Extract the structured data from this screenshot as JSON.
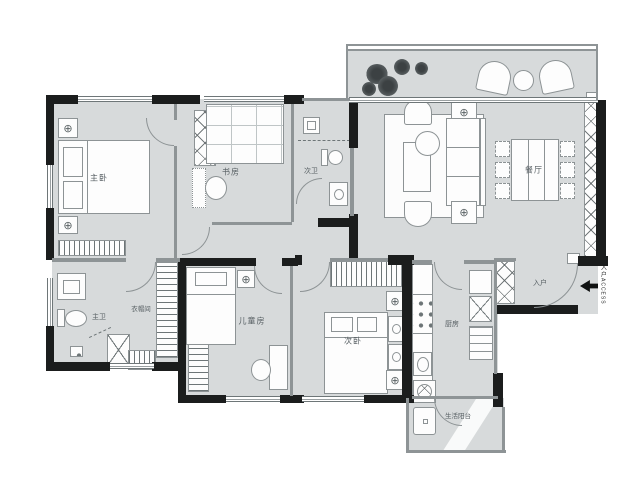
{
  "title": "apartment-floor-plan",
  "rooms": {
    "master_bedroom": "主卧",
    "study": "书房",
    "second_bath": "次卫",
    "dining": "餐厅",
    "master_bath": "主卫",
    "cloakroom": "衣帽间",
    "kids_room": "儿童房",
    "second_bedroom": "次卧",
    "kitchen": "厨房",
    "service_balcony": "生活阳台",
    "entry": "入户"
  },
  "entry_marker": {
    "cn": "入户",
    "en": "ACCESS"
  },
  "icons": {
    "ac_symbol": "⊕"
  },
  "colors": {
    "floor": "#d7dadb",
    "wall": "#1b1d1d",
    "line": "#8d9395",
    "text": "#565e62"
  }
}
